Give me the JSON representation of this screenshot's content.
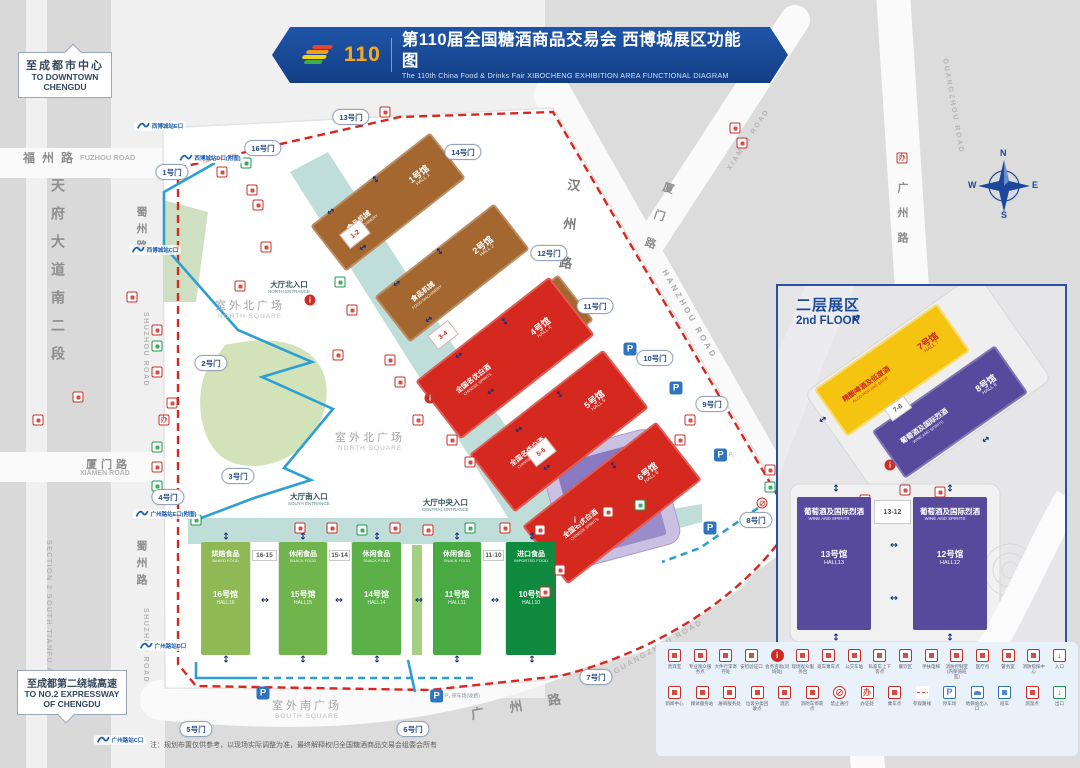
{
  "banner": {
    "edition_badge": "110",
    "title_zh": "第110届全国糖酒商品交易会 西博城展区功能图",
    "title_en": "The 110th China Food & Drinks Fair  XIBOCHENG EXHIBITION AREA FUNCTIONAL DIAGRAM"
  },
  "directions": {
    "north": {
      "zh": "至成都市中心",
      "en": "TO DOWNTOWN CHENGDU"
    },
    "south": {
      "zh": "至成都第二绕城高速",
      "en": "TO NO.2 EXPRESSWAY OF CHENGDU"
    }
  },
  "roads": {
    "fuzhou": {
      "zh": "福州路",
      "en": "FUZHOU ROAD"
    },
    "tianfu": {
      "zh": "天府大道南二段",
      "en": "SECTION 2 SOUTH TIANFU AVENUE"
    },
    "shuzhou": {
      "zh": "蜀州路",
      "en": "SHUZHOU ROAD"
    },
    "xiamen": {
      "zh": "厦门路",
      "en": "XIAMEN ROAD"
    },
    "hanzhou": {
      "zh": "汉州路",
      "en": "HANZHOU ROAD"
    },
    "guangzhou": {
      "zh": "广州路",
      "en": "GUANGZHOU ROAD"
    }
  },
  "squares": {
    "north": {
      "zh": "室外北广场",
      "en": "NORTH SQUARE"
    },
    "south": {
      "zh": "室外南广场",
      "en": "SOUTH SQUARE"
    }
  },
  "entrances": {
    "north": {
      "zh": "大厅北入口",
      "en": "NORTH ENTRANCE"
    },
    "central": {
      "zh": "大厅中央入口",
      "en": "CENTRAL ENTRANCE"
    },
    "south": {
      "zh": "大厅南入口",
      "en": "SOUTH ENTRANCE"
    }
  },
  "halls": {
    "h1": {
      "no": "1号馆",
      "no_en": "HALL 1",
      "cat": "食品机械",
      "cat_en": "FOOD MACHINERY"
    },
    "h2": {
      "no": "2号馆",
      "no_en": "HALL 2",
      "cat": "食品机械",
      "cat_en": "FOOD MACHINERY"
    },
    "h3": {
      "no": "3号馆",
      "no_en": "HALL 3",
      "cat": "食品机械",
      "cat_en": "FOOD MACHINERY"
    },
    "h4": {
      "no": "4号馆",
      "no_en": "HALL 4",
      "cat": "全国名优白酒",
      "cat_en": "CHINESE SPIRITS"
    },
    "h5": {
      "no": "5号馆",
      "no_en": "HALL 5",
      "cat": "全国名优白酒",
      "cat_en": "CHINESE SPIRITS"
    },
    "h6": {
      "no": "6号馆",
      "no_en": "HALL 6",
      "cat": "全国名优白酒",
      "cat_en": "CHINESE SPIRITS"
    },
    "h7": {
      "no": "7号馆",
      "no_en": "HALL 7",
      "cat": "精酿啤酒及低度酒",
      "cat_en": "ALCO-POP AND BEER"
    },
    "h8": {
      "no": "8号馆",
      "no_en": "HALL 8",
      "cat": "葡萄酒及国际烈酒",
      "cat_en": "WINE AND SPIRITS"
    },
    "h10": {
      "no": "10号馆",
      "no_en": "HALL10",
      "cat": "进口食品",
      "cat_en": "IMPORTED FOOD"
    },
    "h11": {
      "no": "11号馆",
      "no_en": "HALL11",
      "cat": "休闲食品",
      "cat_en": "SNACK FOOD"
    },
    "h12": {
      "no": "12号馆",
      "no_en": "HALL12",
      "cat": "葡萄酒及国际烈酒",
      "cat_en": "WINE AND SPIRITS"
    },
    "h13": {
      "no": "13号馆",
      "no_en": "HALL13",
      "cat": "葡萄酒及国际烈酒",
      "cat_en": "WINE AND SPIRITS"
    },
    "h14": {
      "no": "14号馆",
      "no_en": "HALL14",
      "cat": "休闲食品",
      "cat_en": "SNACK FOOD"
    },
    "h15": {
      "no": "15号馆",
      "no_en": "HALL15",
      "cat": "休闲食品",
      "cat_en": "SNACK FOOD"
    },
    "h16": {
      "no": "16号馆",
      "no_en": "HALL16",
      "cat": "烘焙食品",
      "cat_en": "BAKED FOOD"
    }
  },
  "connectors": {
    "c12": "1-2",
    "c34": "3-4",
    "c56": "5-6",
    "c78": "7-8",
    "c1615": "16-15",
    "c1514": "15-14",
    "c1110": "11-10",
    "c1312": "13-12"
  },
  "inset": {
    "title_zh": "二层展区",
    "title_en": "2nd FLOOR"
  },
  "compass": {
    "n": "N",
    "e": "E",
    "s": "S",
    "w": "W"
  },
  "note": "注：规划布置仅供参考，以现场实际调整为准，最终解释权归全国糖酒商品交易会组委会所有",
  "gates": [
    {
      "label": "1号门",
      "x": 172,
      "y": 172
    },
    {
      "label": "2号门",
      "x": 211,
      "y": 363
    },
    {
      "label": "3号门",
      "x": 238,
      "y": 476
    },
    {
      "label": "4号门",
      "x": 168,
      "y": 497
    },
    {
      "label": "5号门",
      "x": 196,
      "y": 729
    },
    {
      "label": "6号门",
      "x": 413,
      "y": 729
    },
    {
      "label": "7号门",
      "x": 596,
      "y": 677
    },
    {
      "label": "8号门",
      "x": 756,
      "y": 520
    },
    {
      "label": "9号门",
      "x": 712,
      "y": 404
    },
    {
      "label": "10号门",
      "x": 655,
      "y": 358
    },
    {
      "label": "11号门",
      "x": 595,
      "y": 306
    },
    {
      "label": "12号门",
      "x": 549,
      "y": 253
    },
    {
      "label": "13号门",
      "x": 351,
      "y": 117
    },
    {
      "label": "14号门",
      "x": 463,
      "y": 152
    },
    {
      "label": "16号门",
      "x": 263,
      "y": 148
    }
  ],
  "metro": [
    {
      "label": "西博城站E口",
      "x": 160,
      "y": 126
    },
    {
      "label": "西博城站D口(附图)",
      "x": 210,
      "y": 158
    },
    {
      "label": "西博城站C口",
      "x": 155,
      "y": 250
    },
    {
      "label": "广州路站E口(附图)",
      "x": 166,
      "y": 514
    },
    {
      "label": "广州路站D口",
      "x": 163,
      "y": 646
    },
    {
      "label": "广州路站C口",
      "x": 120,
      "y": 740
    }
  ],
  "parking": [
    {
      "p": "P",
      "extra": "",
      "x": 630,
      "y": 349
    },
    {
      "p": "P",
      "extra": "",
      "x": 676,
      "y": 388
    },
    {
      "p": "P",
      "extra": "P₁",
      "x": 724,
      "y": 455
    },
    {
      "p": "P",
      "extra": "",
      "x": 710,
      "y": 528
    },
    {
      "p": "P",
      "extra": "P₁ 停车场(收费)",
      "x": 455,
      "y": 696
    },
    {
      "p": "P",
      "extra": "",
      "x": 263,
      "y": 693
    }
  ],
  "map_icons": [
    {
      "x": 132,
      "y": 297,
      "t": "red"
    },
    {
      "x": 78,
      "y": 397,
      "t": "red"
    },
    {
      "x": 38,
      "y": 420,
      "t": "red"
    },
    {
      "x": 157,
      "y": 330,
      "t": "red"
    },
    {
      "x": 157,
      "y": 346,
      "t": "green"
    },
    {
      "x": 157,
      "y": 372,
      "t": "red"
    },
    {
      "x": 172,
      "y": 403,
      "t": "red"
    },
    {
      "x": 164,
      "y": 420,
      "t": "office"
    },
    {
      "x": 157,
      "y": 447,
      "t": "green"
    },
    {
      "x": 157,
      "y": 467,
      "t": "red"
    },
    {
      "x": 157,
      "y": 486,
      "t": "green"
    },
    {
      "x": 196,
      "y": 520,
      "t": "green"
    },
    {
      "x": 246,
      "y": 163,
      "t": "green"
    },
    {
      "x": 222,
      "y": 172,
      "t": "red"
    },
    {
      "x": 252,
      "y": 190,
      "t": "red"
    },
    {
      "x": 258,
      "y": 205,
      "t": "red"
    },
    {
      "x": 266,
      "y": 247,
      "t": "red"
    },
    {
      "x": 240,
      "y": 286,
      "t": "red"
    },
    {
      "x": 310,
      "y": 300,
      "t": "info"
    },
    {
      "x": 340,
      "y": 282,
      "t": "green"
    },
    {
      "x": 385,
      "y": 112,
      "t": "red"
    },
    {
      "x": 352,
      "y": 310,
      "t": "red"
    },
    {
      "x": 338,
      "y": 355,
      "t": "red"
    },
    {
      "x": 390,
      "y": 360,
      "t": "red"
    },
    {
      "x": 400,
      "y": 382,
      "t": "red"
    },
    {
      "x": 430,
      "y": 398,
      "t": "info"
    },
    {
      "x": 418,
      "y": 420,
      "t": "red"
    },
    {
      "x": 452,
      "y": 440,
      "t": "red"
    },
    {
      "x": 470,
      "y": 462,
      "t": "red"
    },
    {
      "x": 300,
      "y": 528,
      "t": "red"
    },
    {
      "x": 332,
      "y": 528,
      "t": "red"
    },
    {
      "x": 362,
      "y": 530,
      "t": "green"
    },
    {
      "x": 395,
      "y": 528,
      "t": "red"
    },
    {
      "x": 428,
      "y": 530,
      "t": "red"
    },
    {
      "x": 470,
      "y": 528,
      "t": "green"
    },
    {
      "x": 505,
      "y": 528,
      "t": "red"
    },
    {
      "x": 540,
      "y": 530,
      "t": "red"
    },
    {
      "x": 575,
      "y": 520,
      "t": "info"
    },
    {
      "x": 608,
      "y": 512,
      "t": "red"
    },
    {
      "x": 640,
      "y": 505,
      "t": "green"
    },
    {
      "x": 735,
      "y": 128,
      "t": "red"
    },
    {
      "x": 742,
      "y": 143,
      "t": "red"
    },
    {
      "x": 902,
      "y": 158,
      "t": "office"
    },
    {
      "x": 770,
      "y": 470,
      "t": "red"
    },
    {
      "x": 770,
      "y": 487,
      "t": "green"
    },
    {
      "x": 762,
      "y": 503,
      "t": "noentry"
    },
    {
      "x": 680,
      "y": 440,
      "t": "red"
    },
    {
      "x": 690,
      "y": 420,
      "t": "red"
    },
    {
      "x": 560,
      "y": 570,
      "t": "red"
    },
    {
      "x": 545,
      "y": 592,
      "t": "red"
    },
    {
      "x": 890,
      "y": 465,
      "t": "info"
    },
    {
      "x": 905,
      "y": 490,
      "t": "red"
    },
    {
      "x": 865,
      "y": 500,
      "t": "red"
    },
    {
      "x": 940,
      "y": 492,
      "t": "red"
    },
    {
      "x": 862,
      "y": 620,
      "t": "red"
    }
  ],
  "flow_arrows": [
    {
      "x": 330,
      "y": 212,
      "rot": 55
    },
    {
      "x": 362,
      "y": 248,
      "rot": 55
    },
    {
      "x": 396,
      "y": 284,
      "rot": 55
    },
    {
      "x": 428,
      "y": 320,
      "rot": 55
    },
    {
      "x": 458,
      "y": 356,
      "rot": 55
    },
    {
      "x": 490,
      "y": 392,
      "rot": 55
    },
    {
      "x": 518,
      "y": 430,
      "rot": 55
    },
    {
      "x": 546,
      "y": 468,
      "rot": 55
    },
    {
      "x": 376,
      "y": 180,
      "rot": -35
    },
    {
      "x": 440,
      "y": 252,
      "rot": -35
    },
    {
      "x": 505,
      "y": 322,
      "rot": -35
    },
    {
      "x": 560,
      "y": 395,
      "rot": -35
    },
    {
      "x": 614,
      "y": 466,
      "rot": -35
    },
    {
      "x": 226,
      "y": 537,
      "rot": 0
    },
    {
      "x": 303,
      "y": 537,
      "rot": 0
    },
    {
      "x": 377,
      "y": 537,
      "rot": 0
    },
    {
      "x": 457,
      "y": 537,
      "rot": 0
    },
    {
      "x": 532,
      "y": 537,
      "rot": 0
    },
    {
      "x": 226,
      "y": 660,
      "rot": 0
    },
    {
      "x": 303,
      "y": 660,
      "rot": 0
    },
    {
      "x": 377,
      "y": 660,
      "rot": 0
    },
    {
      "x": 457,
      "y": 660,
      "rot": 0
    },
    {
      "x": 532,
      "y": 660,
      "rot": 0
    },
    {
      "x": 264,
      "y": 600,
      "rot": 90
    },
    {
      "x": 338,
      "y": 600,
      "rot": 90
    },
    {
      "x": 418,
      "y": 600,
      "rot": 90
    },
    {
      "x": 494,
      "y": 600,
      "rot": 90
    },
    {
      "x": 836,
      "y": 489,
      "rot": 0
    },
    {
      "x": 950,
      "y": 489,
      "rot": 0
    },
    {
      "x": 836,
      "y": 638,
      "rot": 0
    },
    {
      "x": 950,
      "y": 638,
      "rot": 0
    },
    {
      "x": 893,
      "y": 545,
      "rot": 90
    },
    {
      "x": 893,
      "y": 598,
      "rot": 90
    },
    {
      "x": 856,
      "y": 318,
      "rot": 55
    },
    {
      "x": 922,
      "y": 352,
      "rot": 55
    },
    {
      "x": 985,
      "y": 440,
      "rot": 55
    },
    {
      "x": 822,
      "y": 420,
      "rot": 55
    }
  ],
  "legend": {
    "row1": [
      {
        "label": "贵宾室",
        "icon": "vip-room"
      },
      {
        "label": "专业观众服务点",
        "icon": "visitor-service-badge"
      },
      {
        "label": "大件行李寄存处",
        "icon": "luggage-storage"
      },
      {
        "label": "安检验证口",
        "icon": "security-check"
      },
      {
        "label": "会务咨询(问询处)",
        "icon": "information"
      },
      {
        "label": "现场观众服务台",
        "icon": "visitor-service-desk"
      },
      {
        "label": "班车乘车点",
        "icon": "shuttle-bus"
      },
      {
        "label": "公交车站",
        "icon": "bus-station"
      },
      {
        "label": "私家车上下客点",
        "icon": "car-dropoff"
      },
      {
        "label": "餐饮区",
        "icon": "dining-area"
      },
      {
        "label": "手扶电梯",
        "icon": "escalator"
      },
      {
        "label": "消防控制室(内保值班室)",
        "icon": "fire-control-room"
      },
      {
        "label": "医疗点",
        "icon": "medical-point"
      },
      {
        "label": "警务室",
        "icon": "police-office"
      },
      {
        "label": "消防指挥中心",
        "icon": "fire-command-center"
      },
      {
        "label": "入口",
        "icon": "entrance"
      }
    ],
    "row2": [
      {
        "label": "新闻中心",
        "icon": "press-center"
      },
      {
        "label": "媒体服务站",
        "icon": "media-service"
      },
      {
        "label": "展商服务处",
        "icon": "exhibitor-service"
      },
      {
        "label": "垃圾分类回收点",
        "icon": "waste-recycle"
      },
      {
        "label": "酒店",
        "icon": "hotel"
      },
      {
        "label": "消防车停靠点",
        "icon": "fire-truck"
      },
      {
        "label": "禁止通行",
        "icon": "no-entry"
      },
      {
        "label": "办证处",
        "icon": "badge-office"
      },
      {
        "label": "乘车点",
        "icon": "pickup-point"
      },
      {
        "label": "参观路线",
        "icon": "visit-route"
      },
      {
        "label": "停车场",
        "icon": "parking"
      },
      {
        "label": "地铁站出入口",
        "icon": "metro-entrance"
      },
      {
        "label": "班车",
        "icon": "coach-bus"
      },
      {
        "label": "测温点",
        "icon": "temperature-check"
      },
      {
        "label": "出口",
        "icon": "exit"
      }
    ]
  }
}
